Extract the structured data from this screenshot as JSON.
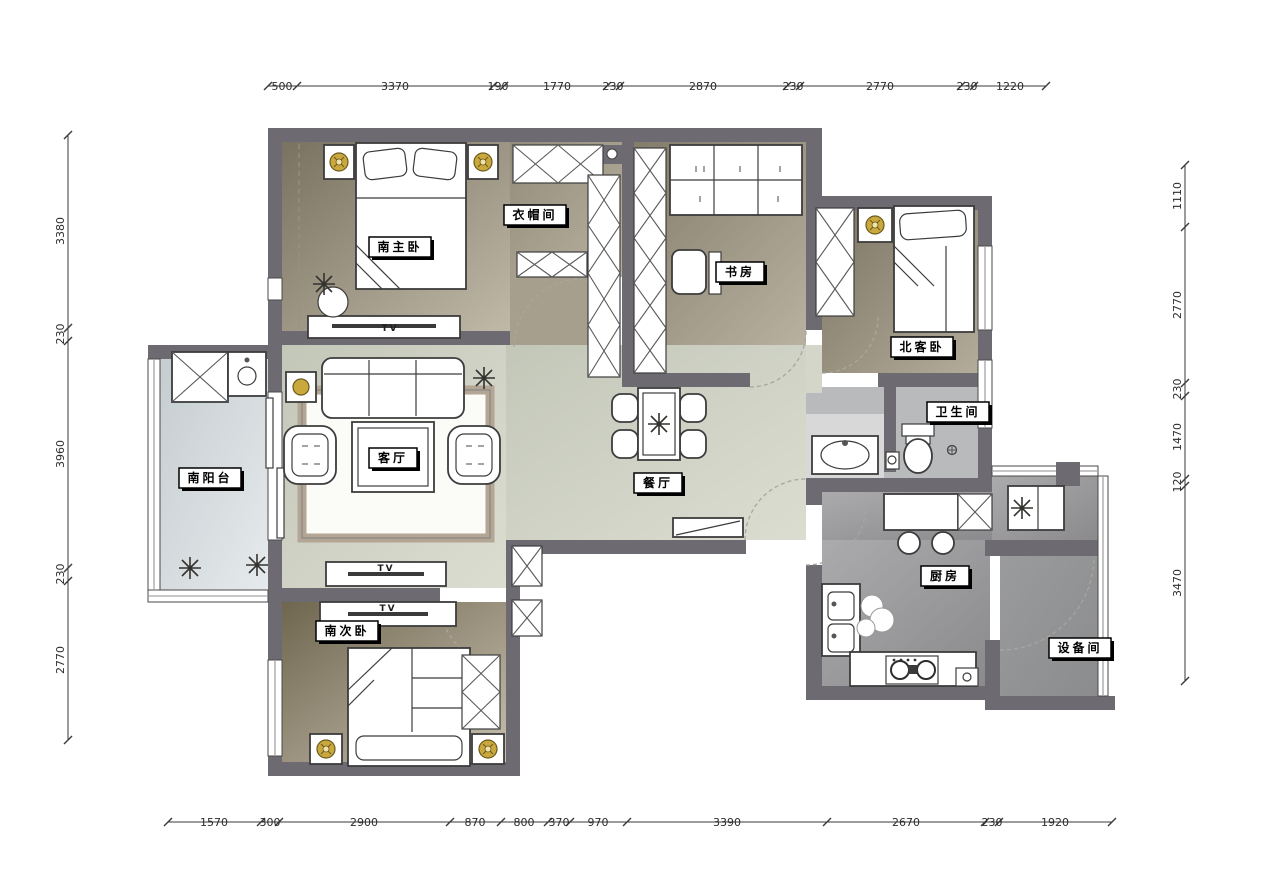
{
  "rooms": {
    "master_bedroom": "南主卧",
    "cloakroom": "衣帽间",
    "study": "书房",
    "north_guest_bedroom": "北客卧",
    "bathroom": "卫生间",
    "south_balcony": "南阳台",
    "living_room": "客厅",
    "dining_room": "餐厅",
    "kitchen": "厨房",
    "south_second_bedroom": "南次卧",
    "equipment_room": "设备间"
  },
  "furniture_labels": {
    "tv_master": "TV",
    "tv_living": "TV",
    "tv_second": "TV"
  },
  "dimensions": {
    "top": [
      "500",
      "3370",
      "190",
      "1770",
      "230",
      "2870",
      "230",
      "2770",
      "230",
      "1220"
    ],
    "bottom": [
      "1570",
      "300",
      "2900",
      "870",
      "800",
      "370",
      "970",
      "3390",
      "2670",
      "230",
      "1920"
    ],
    "left": [
      "3380",
      "230",
      "3960",
      "230",
      "2770"
    ],
    "right": [
      "1110",
      "2770",
      "230",
      "1470",
      "120",
      "3470"
    ]
  },
  "colors": {
    "wall": "#6e6a71",
    "lamp_accent": "#c9a83d",
    "rug_border": "#b3a695",
    "bedroom_floor_dark": "#77705e",
    "bedroom_floor_light": "#c2bbaa",
    "central_floor": "#cbcec0",
    "balcony_floor": "#ccd3d6",
    "kitchen_floor": "#9a9a9c",
    "bathroom_floor": "#b8babc"
  }
}
